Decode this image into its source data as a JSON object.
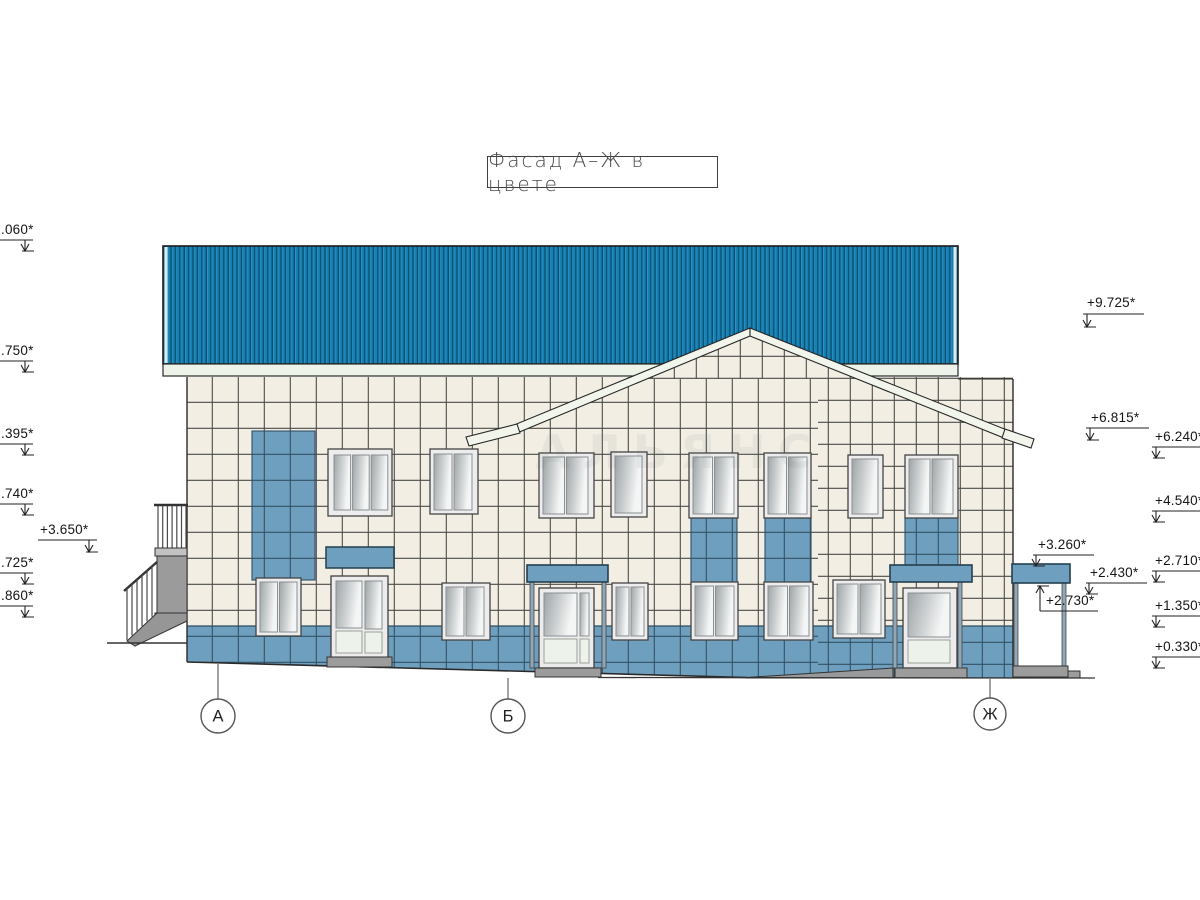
{
  "title": {
    "text": "Фасад А–Ж в цвете"
  },
  "axes": [
    {
      "label": "А"
    },
    {
      "label": "Б"
    },
    {
      "label": "Ж"
    }
  ],
  "markers": {
    "left": [
      ".060*",
      ".750*",
      ".395*",
      ".740*",
      "+3.650*",
      ".725*",
      ".860*"
    ],
    "right_outer": [
      "+9.725*",
      "+6.815*"
    ],
    "right_inner": [
      "+6.240*",
      "+4.540*",
      "+2.710*",
      "+1.350*",
      "+0.330*"
    ],
    "canopy": [
      "+3.260*",
      "+2.430*",
      "+2.730*"
    ]
  },
  "watermark": "АЛЬЯНС",
  "colors": {
    "roof_blue": "#1580b2",
    "roof_corrugation_dark": "#0c4e70",
    "eave_white": "#eef3e9",
    "tile_cream": "#f2eee3",
    "tile_blue": "#6f9fbe",
    "grout_dark": "#3a3a3a",
    "concrete_gray": "#9c9c9c",
    "outline": "#2a2a2a"
  }
}
